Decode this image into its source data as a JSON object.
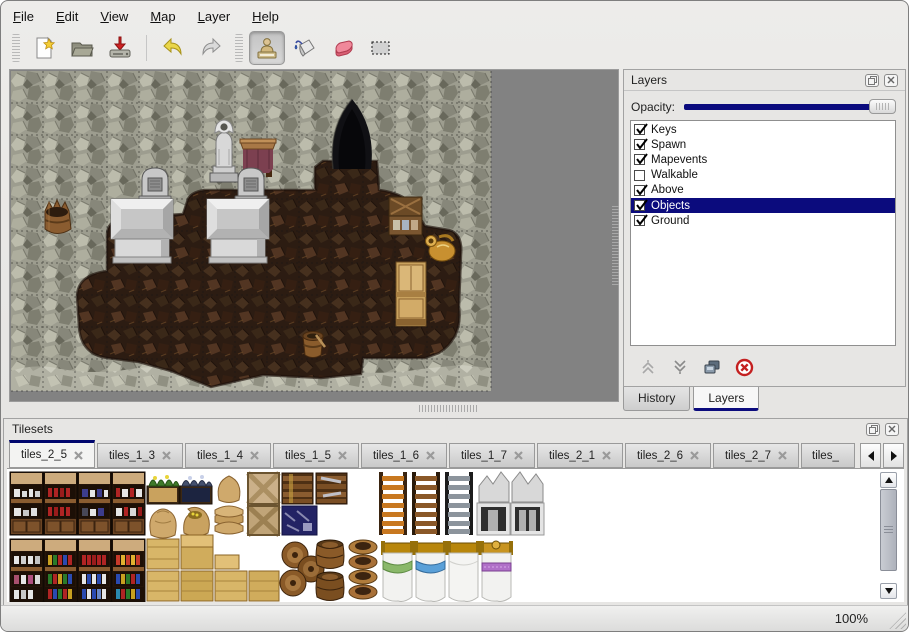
{
  "menubar": {
    "items": [
      {
        "label": "File"
      },
      {
        "label": "Edit"
      },
      {
        "label": "View"
      },
      {
        "label": "Map"
      },
      {
        "label": "Layer"
      },
      {
        "label": "Help"
      }
    ]
  },
  "toolbar": {
    "buttons": [
      {
        "name": "new-file",
        "selected": false
      },
      {
        "name": "open-file",
        "selected": false
      },
      {
        "name": "save-file",
        "selected": false
      },
      {
        "name": "undo",
        "selected": false
      },
      {
        "name": "redo",
        "selected": false
      },
      {
        "name": "stamp-tool",
        "selected": true
      },
      {
        "name": "fill-tool",
        "selected": false
      },
      {
        "name": "eraser-tool",
        "selected": false
      },
      {
        "name": "select-tool",
        "selected": false
      }
    ]
  },
  "map_canvas": {
    "grid_tile_px": 32,
    "objects": [
      "rock-wall",
      "dirt-floor",
      "rubble-floor",
      "cave-entrance",
      "statue",
      "wooden-table",
      "gravestone-left",
      "gravestone-right",
      "stone-altar-left",
      "stone-altar-right",
      "broken-barrel",
      "crate-stack",
      "golden-ewer",
      "wooden-cabinet",
      "wooden-bucket"
    ]
  },
  "layers_panel": {
    "title": "Layers",
    "opacity_label": "Opacity:",
    "opacity_fraction": 1.0,
    "layers": [
      {
        "name": "Keys",
        "visible": true,
        "selected": false
      },
      {
        "name": "Spawn",
        "visible": true,
        "selected": false
      },
      {
        "name": "Mapevents",
        "visible": true,
        "selected": false
      },
      {
        "name": "Walkable",
        "visible": false,
        "selected": false
      },
      {
        "name": "Above",
        "visible": true,
        "selected": false
      },
      {
        "name": "Objects",
        "visible": true,
        "selected": true
      },
      {
        "name": "Ground",
        "visible": true,
        "selected": false
      }
    ],
    "actions": [
      "move-layer-up",
      "move-layer-down",
      "duplicate-layer",
      "delete-layer"
    ]
  },
  "dock_tabs": [
    {
      "label": "History",
      "active": false
    },
    {
      "label": "Layers",
      "active": true
    }
  ],
  "tilesets_panel": {
    "title": "Tilesets",
    "tabs": [
      {
        "label": "tiles_2_5",
        "active": true,
        "truncated": false
      },
      {
        "label": "tiles_1_3",
        "active": false,
        "truncated": false
      },
      {
        "label": "tiles_1_4",
        "active": false,
        "truncated": false
      },
      {
        "label": "tiles_1_5",
        "active": false,
        "truncated": false
      },
      {
        "label": "tiles_1_6",
        "active": false,
        "truncated": false
      },
      {
        "label": "tiles_1_7",
        "active": false,
        "truncated": false
      },
      {
        "label": "tiles_2_1",
        "active": false,
        "truncated": false
      },
      {
        "label": "tiles_2_6",
        "active": false,
        "truncated": false
      },
      {
        "label": "tiles_2_7",
        "active": false,
        "truncated": false
      },
      {
        "label": "tiles_",
        "active": false,
        "truncated": true
      }
    ],
    "tiles": [
      "dish-shelf",
      "bottle-shelf",
      "china-shelf",
      "jar-shelf",
      "planter",
      "grain-sack",
      "open-sack",
      "sack-pile",
      "crate-x",
      "slat-crate",
      "navy-crate",
      "book-shelves",
      "yellow-crates",
      "orange-ladder",
      "brown-ladder",
      "iron-ladder",
      "stone-hearth",
      "barrel-cluster",
      "upright-barrels",
      "clay-pot-stack",
      "bed-green",
      "bed-blue",
      "bed-white",
      "bed-purple"
    ]
  },
  "statusbar": {
    "zoom_level": "100%"
  },
  "colors": {
    "selection_navy": "#0b0b7d",
    "slider_navy": "#0b0b7d",
    "tab_accent": "#00066e",
    "canvas_gray": "#828282"
  }
}
